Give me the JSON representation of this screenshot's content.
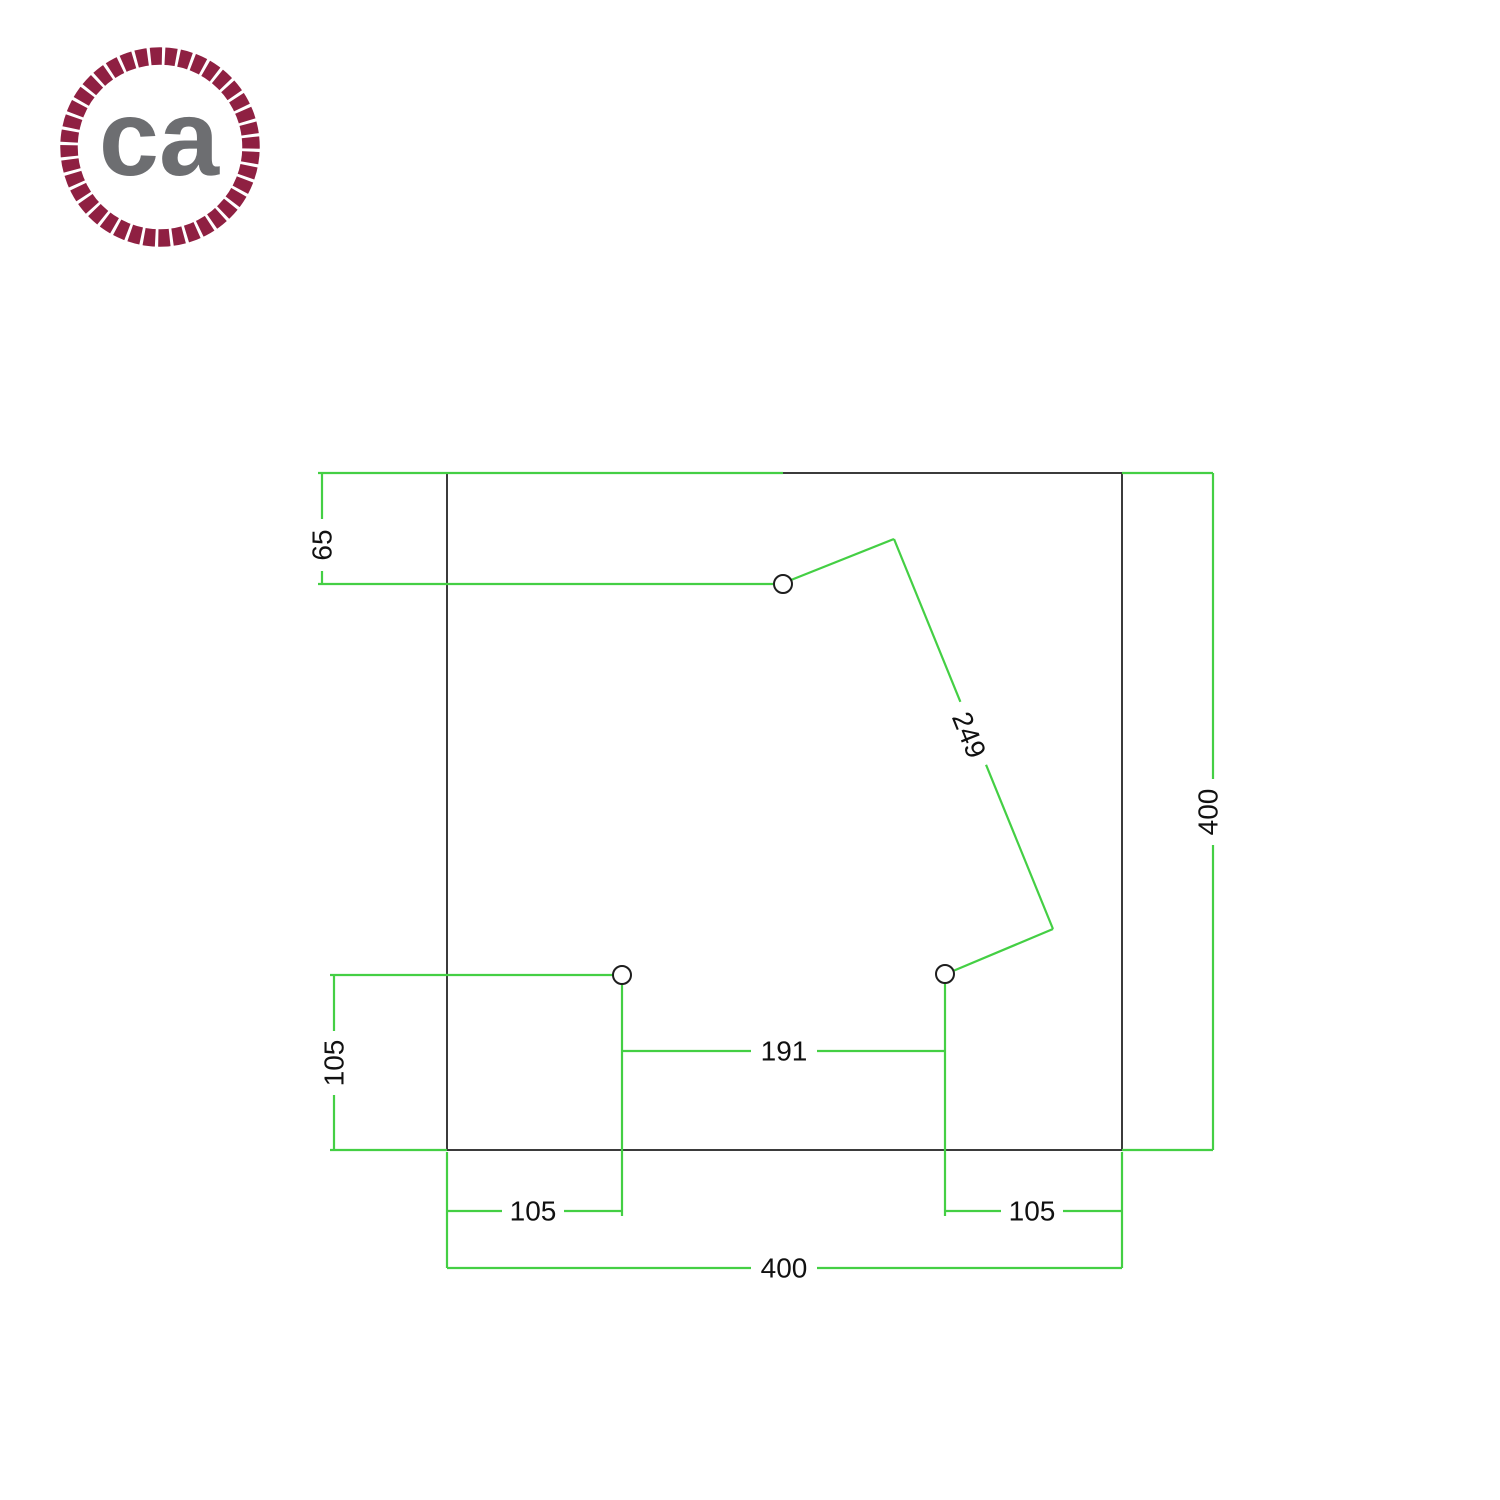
{
  "background": "#ffffff",
  "logo": {
    "text": "ca",
    "rope_color": "#8f2042",
    "text_color": "#6d6e71"
  },
  "drawing": {
    "type": "technical-dimension-diagram",
    "subject": "square plate with 3 drilled holes, top view",
    "colors": {
      "dimension_lines": "#44cf44",
      "plate_outline": "#3b3b3b",
      "label_text": "#111111"
    },
    "plate": {
      "shape": "square",
      "width": "400",
      "height": "400",
      "hole_count": 3
    },
    "labels": {
      "top_hole_from_top": "65",
      "hole_diagonal_distance": "249",
      "left_hole_from_bottom": "105",
      "left_hole_from_left": "105",
      "right_hole_from_right": "105",
      "bottom_holes_distance": "191",
      "plate_width": "400",
      "plate_height": "400"
    }
  }
}
